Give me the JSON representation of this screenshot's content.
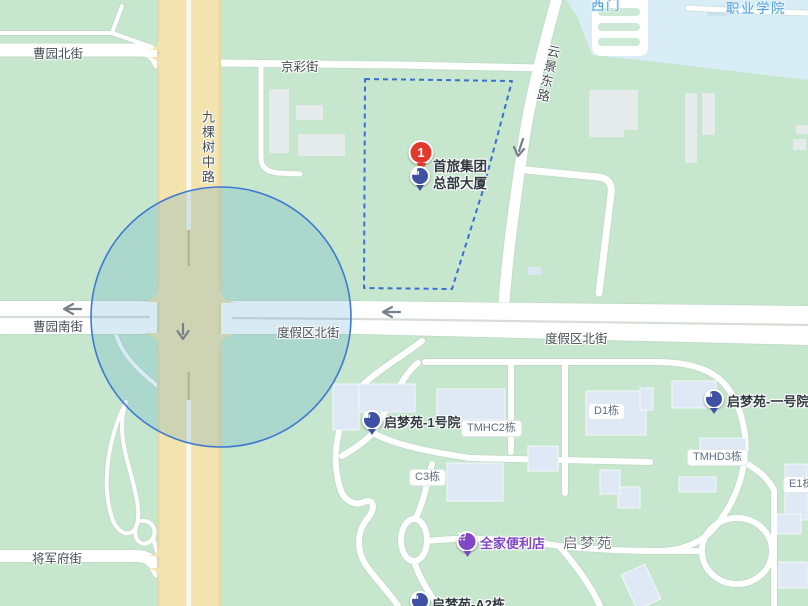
{
  "map": {
    "streets": {
      "caoyuan_north": "曹园北街",
      "jingcai": "京彩街",
      "jiukeshu_middle": "九棵树中路",
      "yunjing_east": "云景东路",
      "caoyuan_south": "曹园南街",
      "dujiaqu_north": "度假区北街",
      "jiangjunfu": "将军府街"
    },
    "areas": {
      "vocational_college": "职业学院",
      "west_gate": "西门",
      "qimengyuan": "启梦苑"
    },
    "buildings": {
      "tmhc2": "TMHC2栋",
      "d1": "D1栋",
      "c3": "C3栋",
      "tmhd3": "TMHD3栋",
      "e1": "E1栋"
    },
    "pois": {
      "result_marker": {
        "badge": "1",
        "line1": "首旅集团",
        "line2": "总部大厦"
      },
      "qmy_court1": "启梦苑-1号院",
      "qmy_no1": "启梦苑-一号院",
      "familymart": "全家便利店",
      "qmy_a2": "启梦苑-A2栋"
    },
    "colors": {
      "base_green": "#C6E7CE",
      "main_road_tan": "#F3E3AE",
      "campus_blue": "#D8EDF5",
      "selection_stroke": "#3E79D2",
      "selection_fill": "rgba(73,158,200,0.21)",
      "boundary_dash": "#3A6FD0",
      "marker_red": "#E2382D",
      "poi_blue": "#3F51A3",
      "poi_purple": "#8247C5",
      "campus_label_blue": "#54A0DC"
    }
  }
}
